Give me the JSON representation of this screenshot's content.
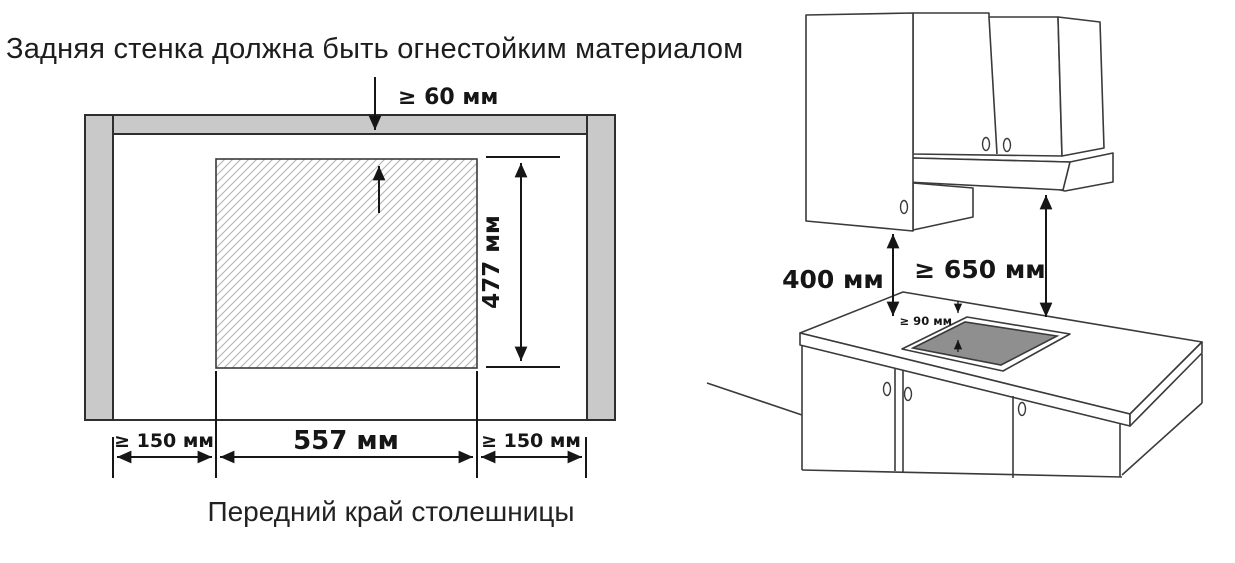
{
  "title": "Задняя стенка должна быть огнестойким материалом",
  "cutout_diagram": {
    "caption_bottom": "Передний край столешницы",
    "dims": {
      "top_clearance": "≥ 60 мм",
      "cutout_depth": "477 мм",
      "cutout_width": "557 мм",
      "left_clearance": "≥ 150 мм",
      "right_clearance": "≥ 150 мм"
    }
  },
  "installation_diagram": {
    "dims": {
      "cabinet_to_worktop": "400 мм",
      "hood_to_hob": "≥ 650 мм",
      "rear_clearance": "≥ 90 мм"
    }
  },
  "colors": {
    "wall_fill": "#c9c9c9",
    "hatch_line": "#b3b3b3",
    "hob_glass": "#8f8f8f",
    "outline": "#3a3a3a",
    "dim_text": "#161616"
  }
}
